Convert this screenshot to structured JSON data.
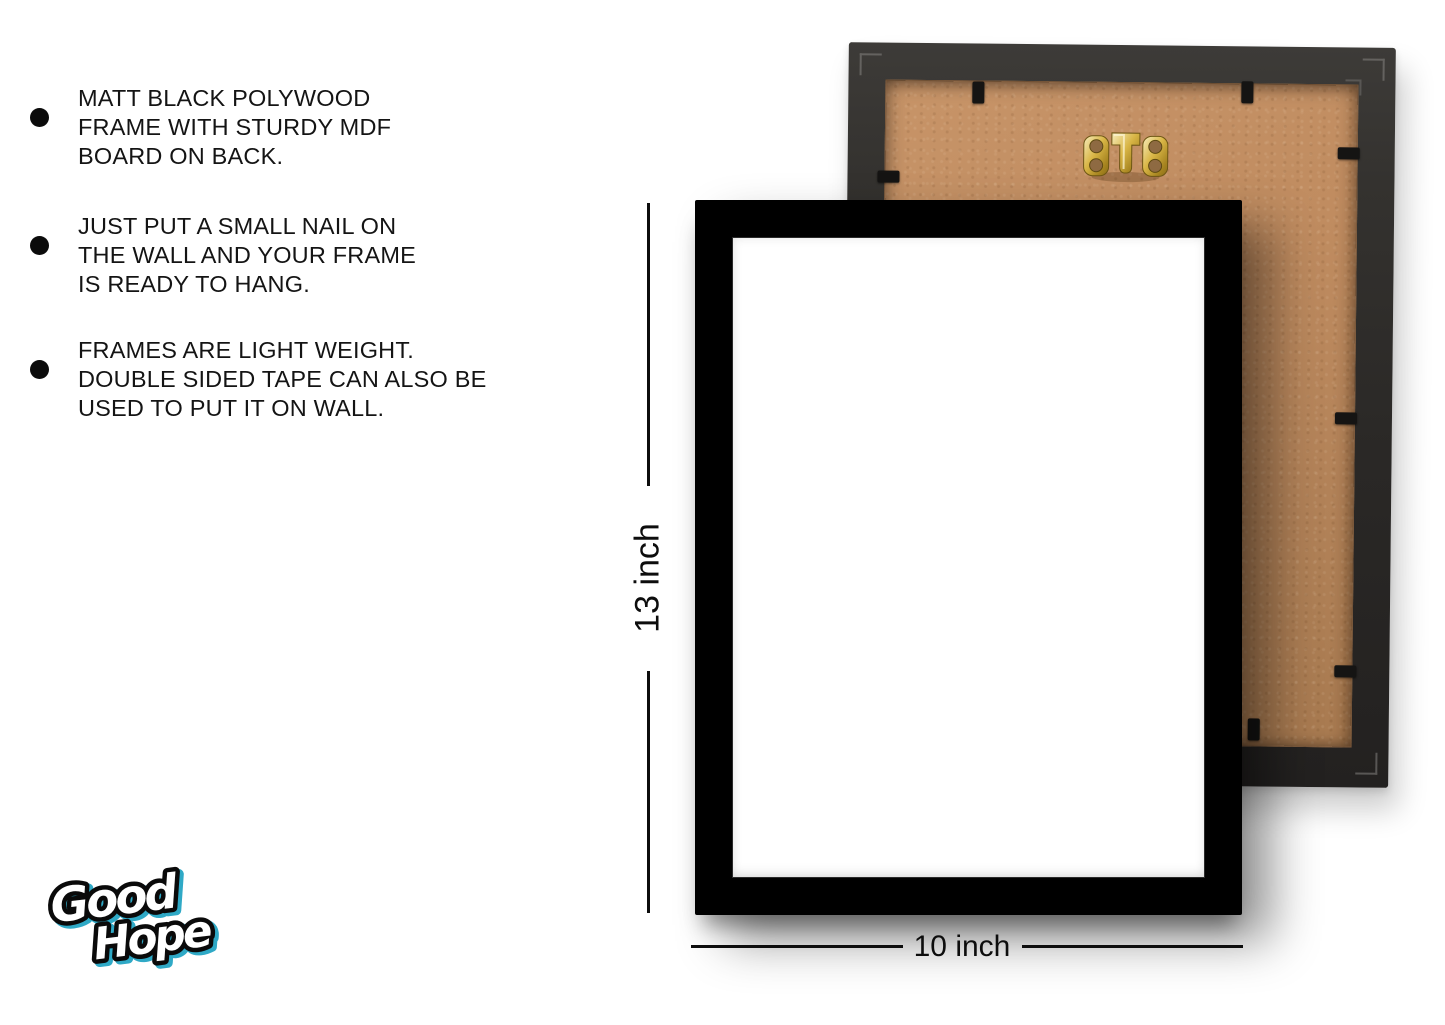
{
  "page": {
    "background": "#ffffff"
  },
  "features": {
    "items": [
      {
        "lines": [
          "MATT BLACK POLYWOOD",
          "FRAME WITH STURDY MDF",
          "BOARD ON BACK."
        ]
      },
      {
        "lines": [
          "JUST PUT A SMALL NAIL ON",
          "THE WALL AND YOUR FRAME",
          "IS READY TO HANG."
        ]
      },
      {
        "lines": [
          "FRAMES ARE LIGHT WEIGHT.",
          "DOUBLE SIDED TAPE CAN ALSO BE",
          "USED TO PUT IT ON WALL."
        ]
      }
    ]
  },
  "dimensions": {
    "height_label": "13 inch",
    "width_label": "10 inch"
  },
  "logo": {
    "line1": "Good",
    "line2": "Hope"
  },
  "frames": {
    "front": {
      "frame_color": "#000000",
      "inner_color": "#ffffff"
    },
    "back": {
      "border_color": "#2b2927",
      "board_color": "#b98a5e",
      "hanger_color": "#d8b545",
      "clip_color": "#151413"
    }
  }
}
